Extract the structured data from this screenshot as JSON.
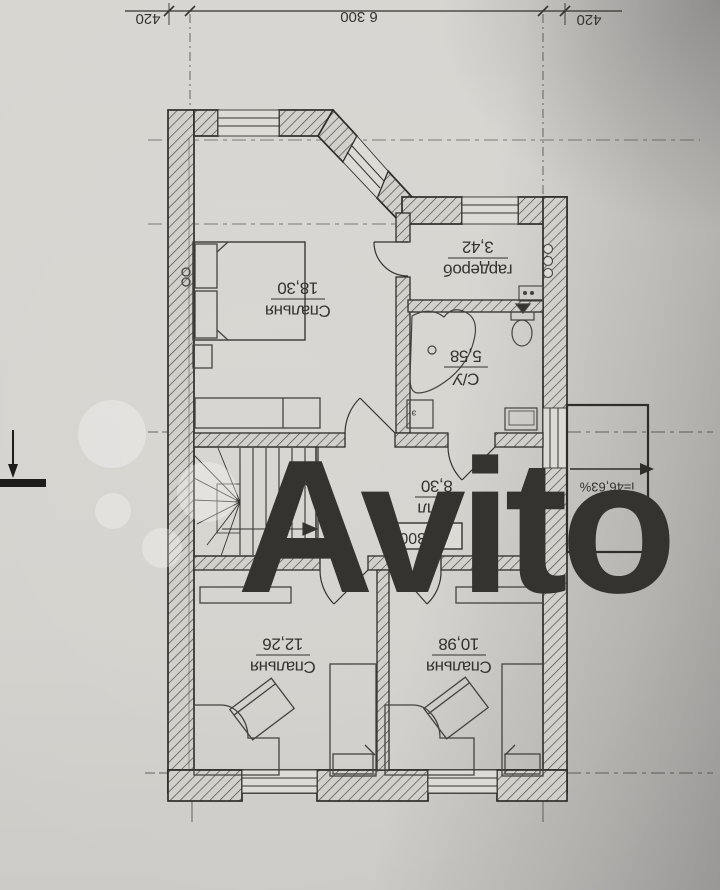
{
  "document": {
    "kind": "floor-plan-photo",
    "orientation": "plan rotated 180 degrees"
  },
  "dimensions": {
    "left_offset": "420",
    "span": "6 300",
    "right_offset": "420"
  },
  "rooms": [
    {
      "name": "Спальня",
      "area": "18,30"
    },
    {
      "name": "гардероб",
      "area": "3,42"
    },
    {
      "name": "С/У",
      "area": "5,58"
    },
    {
      "name": "Холл",
      "area": "8,30"
    },
    {
      "name": "Спальня",
      "area": "12,26"
    },
    {
      "name": "Спальня",
      "area": "10,98"
    }
  ],
  "annotations": {
    "level_mark": "+3.300",
    "slope": "i=46,63%",
    "equipment_tag": "э"
  },
  "watermark": {
    "text": "Avito"
  },
  "colors": {
    "paper": "#d5d3ce",
    "ink": "#35332f",
    "wall_hatch": "#4e4c48",
    "watermark": "rgba(255,255,255,0.30)"
  }
}
